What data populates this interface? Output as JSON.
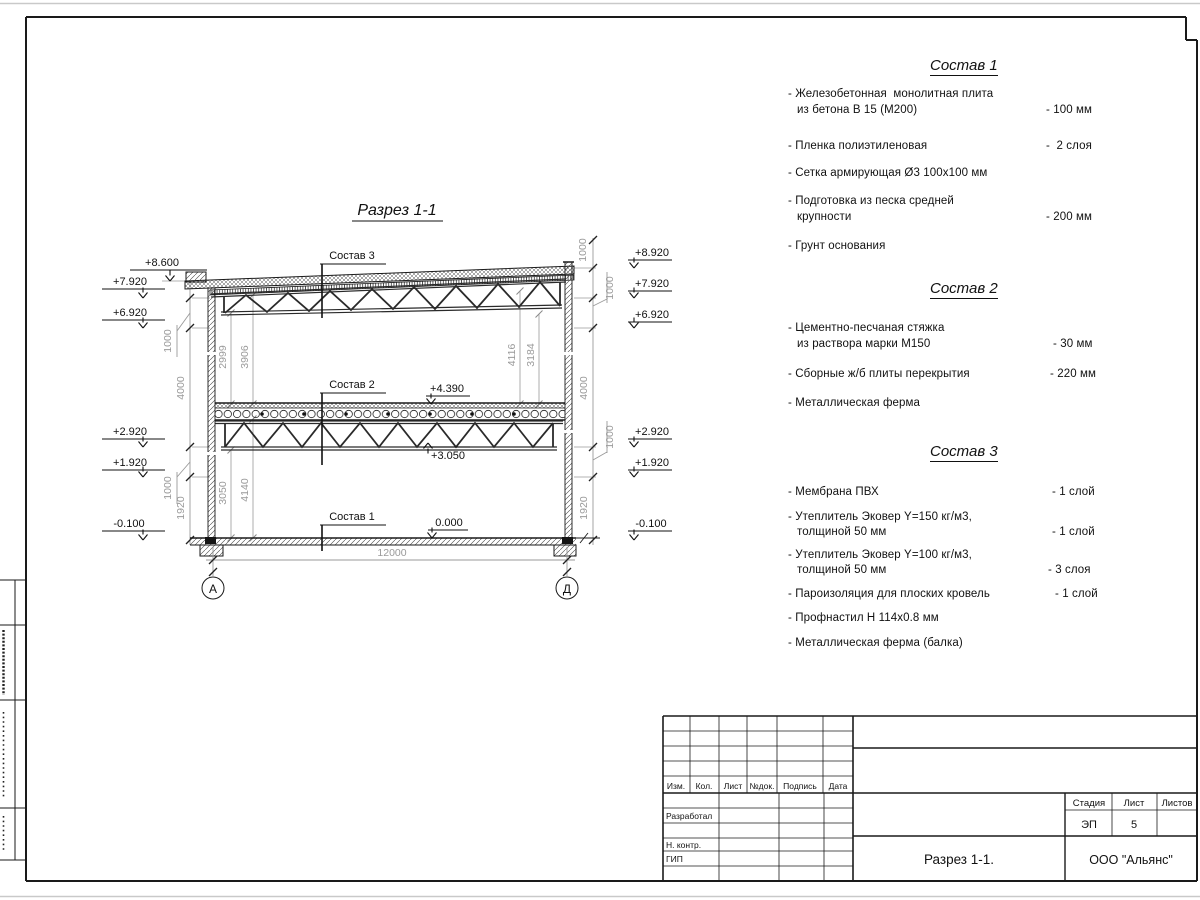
{
  "page": {
    "section_title": "Разрез 1-1",
    "axes": {
      "left": "А",
      "right": "Д"
    },
    "dims": {
      "span": "12000",
      "left_chain": [
        "1000",
        "4000",
        "1000",
        "1920"
      ],
      "right_chain": [
        "1000",
        "1000",
        "4000",
        "1000",
        "1920"
      ],
      "inner": {
        "d2999": "2999",
        "d3906": "3906",
        "d4116": "4116",
        "d3184": "3184",
        "d3050": "3050",
        "d4140": "4140"
      }
    },
    "elevations": {
      "left": [
        "+8.600",
        "+7.920",
        "+6.920",
        "+2.920",
        "+1.920",
        "-0.100"
      ],
      "right": [
        "+8.920",
        "+7.920",
        "+6.920",
        "+2.920",
        "+1.920",
        "-0.100"
      ],
      "mid_top": "+4.390",
      "mid_bottom": "+3.050",
      "floor": "0.000"
    },
    "layer_refs": [
      "Состав 3",
      "Состав 2",
      "Состав 1"
    ]
  },
  "specs": [
    {
      "title": "Состав 1",
      "items": [
        {
          "line1": "- Железобетонная  монолитная плита",
          "line2": "из бетона В 15 (М200)",
          "value": "- 100 мм"
        },
        {
          "line1": "- Пленка полиэтиленовая",
          "value": "-  2 слоя"
        },
        {
          "line1": "- Сетка армирующая Ø3 100х100 мм"
        },
        {
          "line1": "- Подготовка из песка средней",
          "line2": "крупности",
          "value": "- 200 мм"
        },
        {
          "line1": "- Грунт основания"
        }
      ]
    },
    {
      "title": "Состав 2",
      "items": [
        {
          "line1": "- Цементно-песчаная стяжка",
          "line2": "из раствора марки М150",
          "value": "- 30 мм"
        },
        {
          "line1": "- Сборные ж/б плиты перекрытия",
          "value": "- 220 мм"
        },
        {
          "line1": "- Металлическая ферма"
        }
      ]
    },
    {
      "title": "Состав 3",
      "items": [
        {
          "line1": "- Мембрана ПВХ",
          "value": "- 1 слой"
        },
        {
          "line1": "- Утеплитель Эковер Y=150 кг/м3,",
          "line2": "толщиной 50 мм",
          "value": "- 1 слой"
        },
        {
          "line1": "- Утеплитель Эковер Y=100 кг/м3,",
          "line2": "толщиной 50 мм",
          "value": "- 3 слоя"
        },
        {
          "line1": "- Пароизоляция для плоских кровель",
          "value": "- 1 слой"
        },
        {
          "line1": "- Профнастил Н 114х0.8 мм"
        },
        {
          "line1": "- Металлическая ферма (балка)"
        }
      ]
    }
  ],
  "titleblock": {
    "cols": [
      "Изм.",
      "Кол.",
      "Лист",
      "№док.",
      "Подпись",
      "Дата"
    ],
    "rows": [
      "Разработал",
      "Н. контр.",
      "ГИП"
    ],
    "stage_label": "Стадия",
    "sheet_label": "Лист",
    "sheets_label": "Листов",
    "stage": "ЭП",
    "sheet": "5",
    "doc_title": "Разрез  1-1.",
    "company": "ООО \"Альянс\""
  }
}
